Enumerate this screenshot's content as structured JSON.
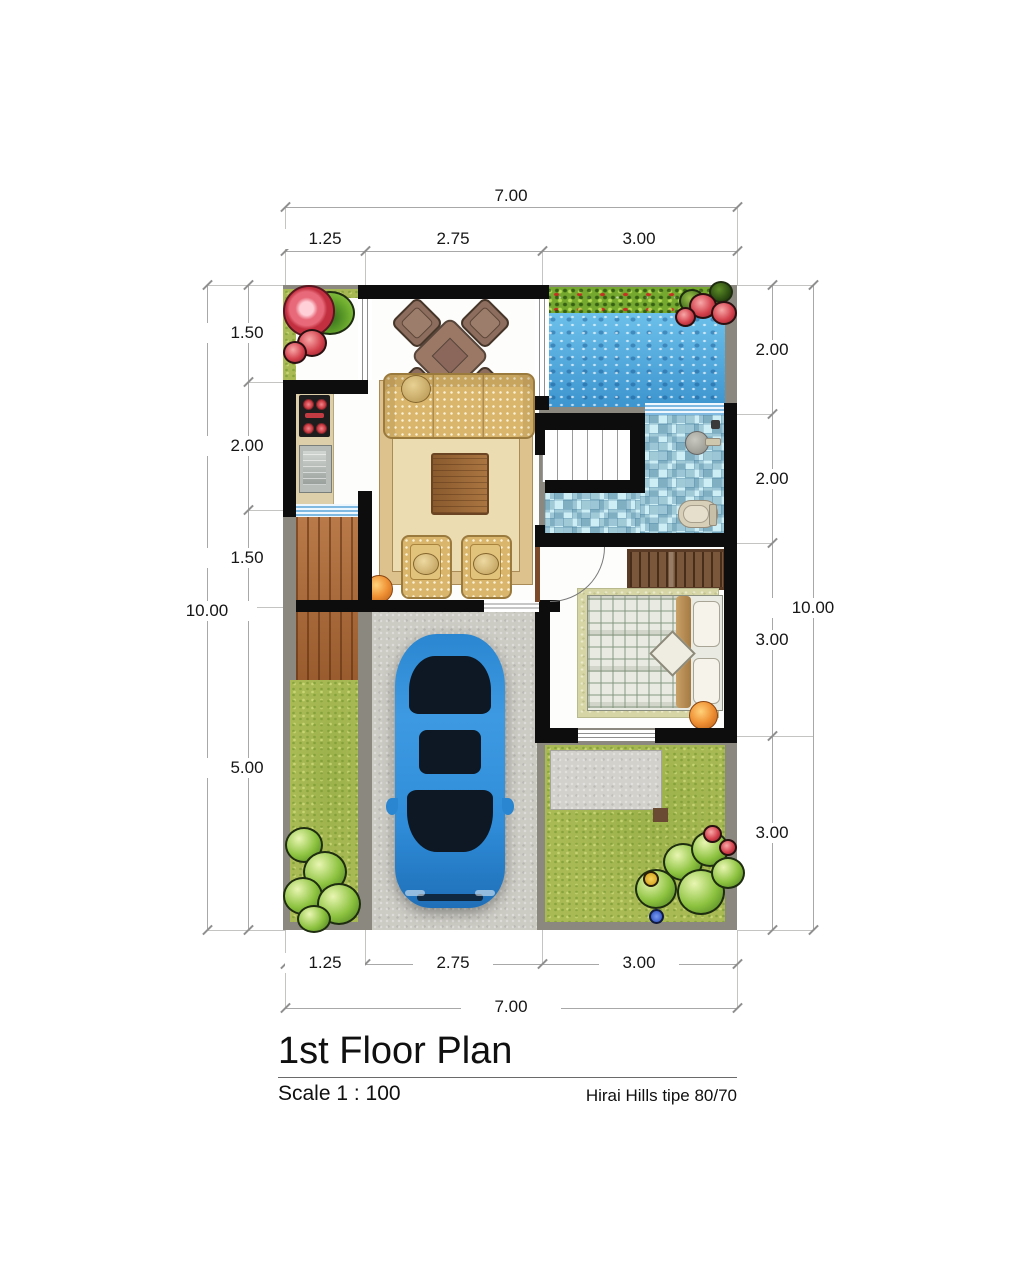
{
  "title_block": {
    "title": "1st Floor Plan",
    "scale": "Scale 1 : 100",
    "project": "Hirai Hills tipe 80/70"
  },
  "dimensions": {
    "top": {
      "total": "7.00",
      "segments": [
        "1.25",
        "2.75",
        "3.00"
      ]
    },
    "bottom": {
      "total": "7.00",
      "segments": [
        "1.25",
        "2.75",
        "3.00"
      ]
    },
    "left": {
      "total": "10.00",
      "segments": [
        "1.50",
        "2.00",
        "1.50",
        "5.00"
      ]
    },
    "right": {
      "total": "10.00",
      "segments": [
        "2.00",
        "2.00",
        "3.00",
        "3.00"
      ]
    }
  },
  "colors": {
    "wall": "#0d0d0d",
    "paving_gray": "#8b897f",
    "grass": "#a9ba55",
    "pool_water": "#57aede",
    "bath_tile": "#cdeef4",
    "deck_wood": "#b26b35",
    "concrete": "#cccbc4",
    "car_blue": "#2e8ed8",
    "sofa_tan": "#d9b66c",
    "accent_orange": "#ef9034"
  }
}
